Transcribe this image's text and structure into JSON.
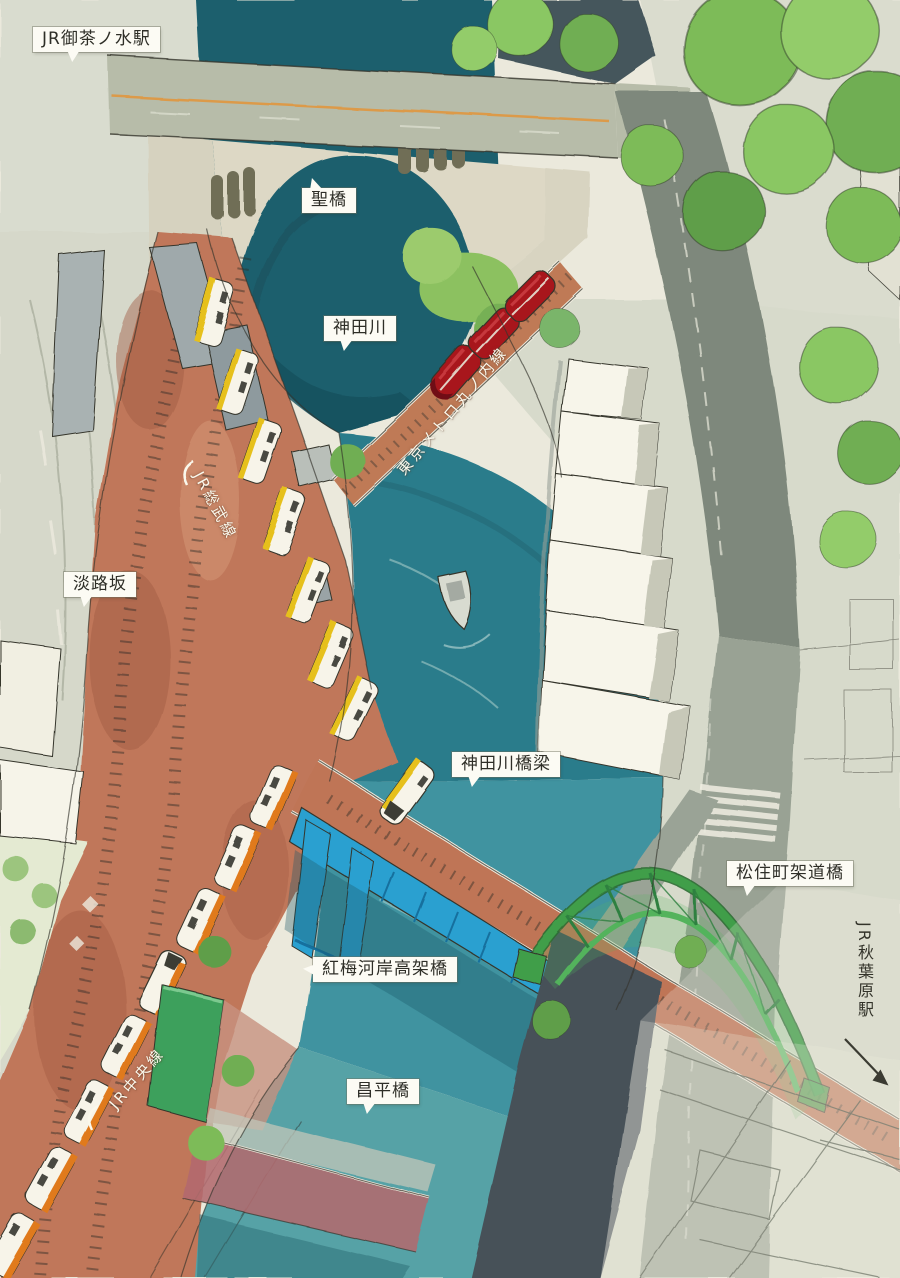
{
  "labels": {
    "ochanomizu_station": "JR御茶ノ水駅",
    "hijiribashi": "聖橋",
    "kandagawa": "神田川",
    "marunouchi_line": "東京メトロ丸ノ内線",
    "sobu_line": "JR総武線",
    "awajizaka": "淡路坂",
    "kandagawa_bridge": "神田川橋梁",
    "matsuzumicho_bridge": "松住町架道橋",
    "akihabara_station": "JR秋葉原駅",
    "kobai_kashi_viaduct": "紅梅河岸高架橋",
    "chuo_line": "JR中央線",
    "shoheibashi": "昌平橋"
  },
  "colors": {
    "paper": "#ebe9dc",
    "river_deep": "#1d5f6d",
    "river_mid": "#2b7c8b",
    "river_light": "#57a2a6",
    "brick_viaduct": "#c0775a",
    "green_bridge": "#3f9e49",
    "blue_bridge": "#2aa0d0",
    "red_train": "#a8191f",
    "sobu_yellow": "#e6c01f",
    "chuo_orange": "#e07a1f",
    "tree_green": "#7dbb58",
    "ink": "#34342c"
  }
}
